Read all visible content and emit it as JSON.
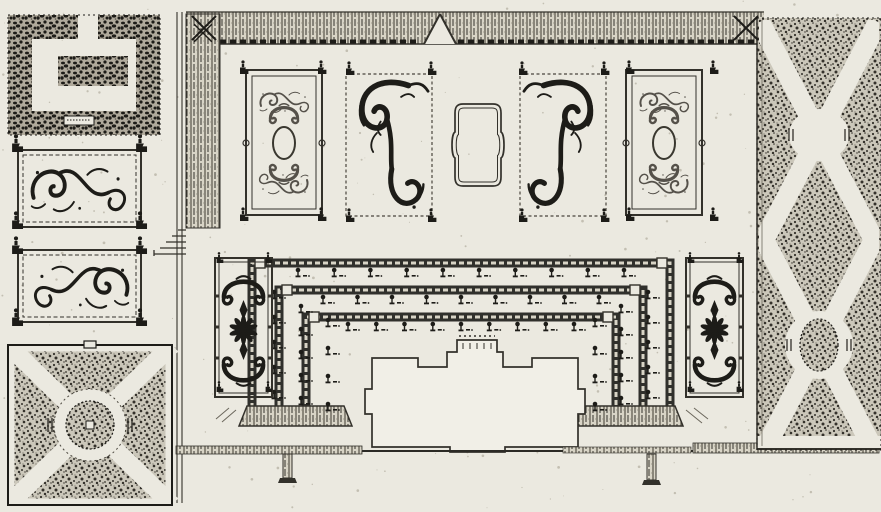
{
  "meta": {
    "title": "Engraved plan of a baroque palace garden — scanned black-ink plate on aged paper",
    "visible_text": "none (only illegible engraver's marks on a tiny plate in the top-left parterre)"
  },
  "palette": {
    "paper": "#ebe9e0",
    "paper_light": "#f1efe7",
    "ink": "#1d1c18",
    "line": "#33312b",
    "light_ornament": "#55514a",
    "stipple_bg": "#cbc7ba",
    "stipple_dot": "#34312b",
    "stipple_dense_bg": "#b0aa9c",
    "hatch_bg": "#d8d4c6",
    "speck": "#c3bfb2"
  },
  "regions": [
    {
      "id": "maze-square",
      "label": "square hedge parterre with meander block, top left"
    },
    {
      "id": "scroll-bed-upper",
      "label": "scrollwork parterre bed, upper left"
    },
    {
      "id": "scroll-bed-lower",
      "label": "scrollwork parterre bed, lower left"
    },
    {
      "id": "diagonal-bosquet",
      "label": "square bosquet with diagonal walks and round fountain, bottom left"
    },
    {
      "id": "terrace-walk-top",
      "label": "raised hatched terrace walk along the top with central steps"
    },
    {
      "id": "terrace-walk-left",
      "label": "raised hatched terrace walk on the left with side stairs"
    },
    {
      "id": "broderie-light-left",
      "label": "light broderie parterre with oval centre"
    },
    {
      "id": "broderie-bold-left",
      "label": "bold S-scroll broderie parterre"
    },
    {
      "id": "central-cartouche",
      "label": "central cartouche bed with notched oval frame"
    },
    {
      "id": "broderie-bold-right",
      "label": "bold S-scroll broderie parterre, mirrored"
    },
    {
      "id": "broderie-light-right",
      "label": "light broderie parterre with oval centre, mirrored"
    },
    {
      "id": "horseshoe-terraces",
      "label": "three nested horseshoe hedge terraces lined with topiary trees"
    },
    {
      "id": "palmette-bed-left",
      "label": "palmette and rosette bed left of the horseshoe"
    },
    {
      "id": "palmette-bed-right",
      "label": "palmette and rosette bed right of the horseshoe"
    },
    {
      "id": "palace-footprint",
      "label": "palace building footprint with central bay and side risalits"
    },
    {
      "id": "terrace-wall-bottom",
      "label": "bottom terrace wall with two gate piers"
    },
    {
      "id": "bosquet-strip-right",
      "label": "right bosquet strip, crossing diagonal walks, lens opening and oval island"
    }
  ],
  "topiary": {
    "glyph": "dot-crowned tree with stem and ground dash",
    "rows": [
      {
        "y": 276,
        "x1": 298,
        "x2": 624,
        "count": 10
      },
      {
        "y": 303,
        "x1": 323,
        "x2": 599,
        "count": 9
      },
      {
        "y": 330,
        "x1": 348,
        "x2": 574,
        "count": 9
      }
    ],
    "columns": [
      {
        "x": 274,
        "y1": 298,
        "y2": 398,
        "count": 5
      },
      {
        "x": 301,
        "y1": 312,
        "y2": 404,
        "count": 5
      },
      {
        "x": 328,
        "y1": 326,
        "y2": 410,
        "count": 4
      },
      {
        "x": 648,
        "y1": 298,
        "y2": 398,
        "count": 5
      },
      {
        "x": 621,
        "y1": 312,
        "y2": 404,
        "count": 5
      },
      {
        "x": 595,
        "y1": 326,
        "y2": 410,
        "count": 4
      }
    ]
  },
  "finials": [
    {
      "x": 243,
      "y": 74,
      "s": 1
    },
    {
      "x": 321,
      "y": 74,
      "s": 1
    },
    {
      "x": 243,
      "y": 221,
      "s": 1
    },
    {
      "x": 321,
      "y": 221,
      "s": 1
    },
    {
      "x": 349,
      "y": 75,
      "s": 1
    },
    {
      "x": 431,
      "y": 75,
      "s": 1
    },
    {
      "x": 349,
      "y": 222,
      "s": 1
    },
    {
      "x": 431,
      "y": 222,
      "s": 1
    },
    {
      "x": 522,
      "y": 75,
      "s": 1
    },
    {
      "x": 604,
      "y": 75,
      "s": 1
    },
    {
      "x": 522,
      "y": 222,
      "s": 1
    },
    {
      "x": 604,
      "y": 222,
      "s": 1
    },
    {
      "x": 629,
      "y": 74,
      "s": 1
    },
    {
      "x": 713,
      "y": 74,
      "s": 1
    },
    {
      "x": 629,
      "y": 221,
      "s": 1
    },
    {
      "x": 713,
      "y": 221,
      "s": 1
    },
    {
      "x": 16,
      "y": 152,
      "s": 1.3
    },
    {
      "x": 140,
      "y": 152,
      "s": 1.3
    },
    {
      "x": 16,
      "y": 229,
      "s": 1.3
    },
    {
      "x": 140,
      "y": 229,
      "s": 1.3
    },
    {
      "x": 16,
      "y": 254,
      "s": 1.3
    },
    {
      "x": 140,
      "y": 254,
      "s": 1.3
    },
    {
      "x": 16,
      "y": 326,
      "s": 1.3
    },
    {
      "x": 140,
      "y": 326,
      "s": 1.3
    },
    {
      "x": 219,
      "y": 263,
      "s": 0.8
    },
    {
      "x": 268,
      "y": 263,
      "s": 0.8
    },
    {
      "x": 219,
      "y": 392,
      "s": 0.8
    },
    {
      "x": 268,
      "y": 392,
      "s": 0.8
    },
    {
      "x": 690,
      "y": 263,
      "s": 0.8
    },
    {
      "x": 739,
      "y": 263,
      "s": 0.8
    },
    {
      "x": 690,
      "y": 392,
      "s": 0.8
    },
    {
      "x": 739,
      "y": 392,
      "s": 0.8
    }
  ],
  "xmarks": [
    {
      "x": 204,
      "y": 28,
      "s": 0.75
    },
    {
      "x": 746,
      "y": 28,
      "s": 0.75
    },
    {
      "x": 203,
      "y": 33,
      "s": 0.55
    }
  ],
  "rosettes": [
    {
      "x": 243.5,
      "y": 330,
      "petals": 10,
      "r": 13
    },
    {
      "x": 714.5,
      "y": 330,
      "petals": 10,
      "r": 13
    }
  ],
  "bastions": [
    {
      "x": 260,
      "y": 263
    },
    {
      "x": 662,
      "y": 263
    },
    {
      "x": 287,
      "y": 290
    },
    {
      "x": 635,
      "y": 290
    },
    {
      "x": 314,
      "y": 317
    },
    {
      "x": 608,
      "y": 317
    }
  ],
  "texture": {
    "specks": 260
  }
}
